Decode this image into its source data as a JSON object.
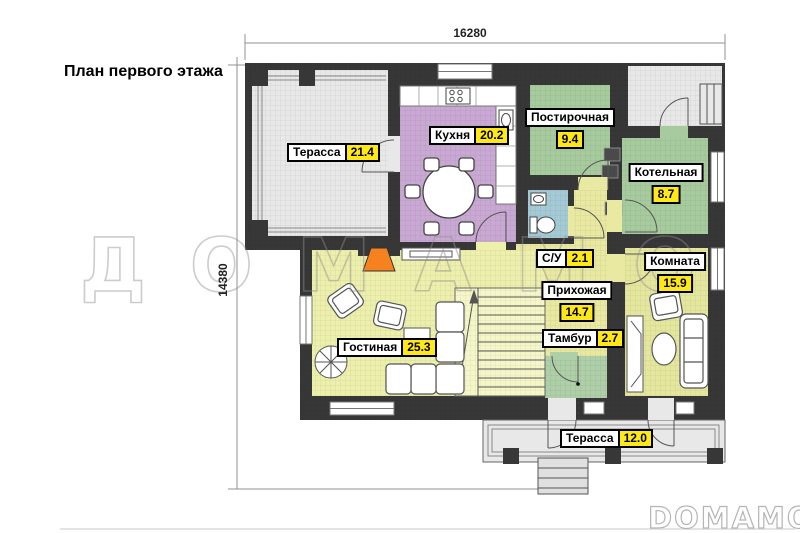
{
  "page": {
    "title": "План первого этажа"
  },
  "dimensions": {
    "top": "16280",
    "left": "14380"
  },
  "watermarks": {
    "center": "ДОМАМО",
    "corner": "DOMAMO"
  },
  "rooms": [
    {
      "name": "Терасса",
      "area": "21.4"
    },
    {
      "name": "Кухня",
      "area": "20.2"
    },
    {
      "name": "Постирочная",
      "area": "9.4"
    },
    {
      "name": "Котельная",
      "area": "8.7"
    },
    {
      "name": "С/У",
      "area": "2.1"
    },
    {
      "name": "Комната",
      "area": "15.9"
    },
    {
      "name": "Прихожая",
      "area": "14.7"
    },
    {
      "name": "Тамбур",
      "area": "2.7"
    },
    {
      "name": "Гостиная",
      "area": "25.3"
    },
    {
      "name": "Терасса",
      "area": "12.0"
    }
  ],
  "colors": {
    "wall": "#373737",
    "terrace": "#e8e8e8",
    "kitchen": "#c9a9d3",
    "green": "#a7cb9e",
    "wc": "#a4cad6",
    "hall": "#e9e9a2",
    "living": "#edefac",
    "room": "#e5e79e",
    "tambour": "#aecfa7",
    "stairs": "#f6f7c9",
    "value_bg": "#ffe818",
    "fireplace": "#f5821f"
  }
}
